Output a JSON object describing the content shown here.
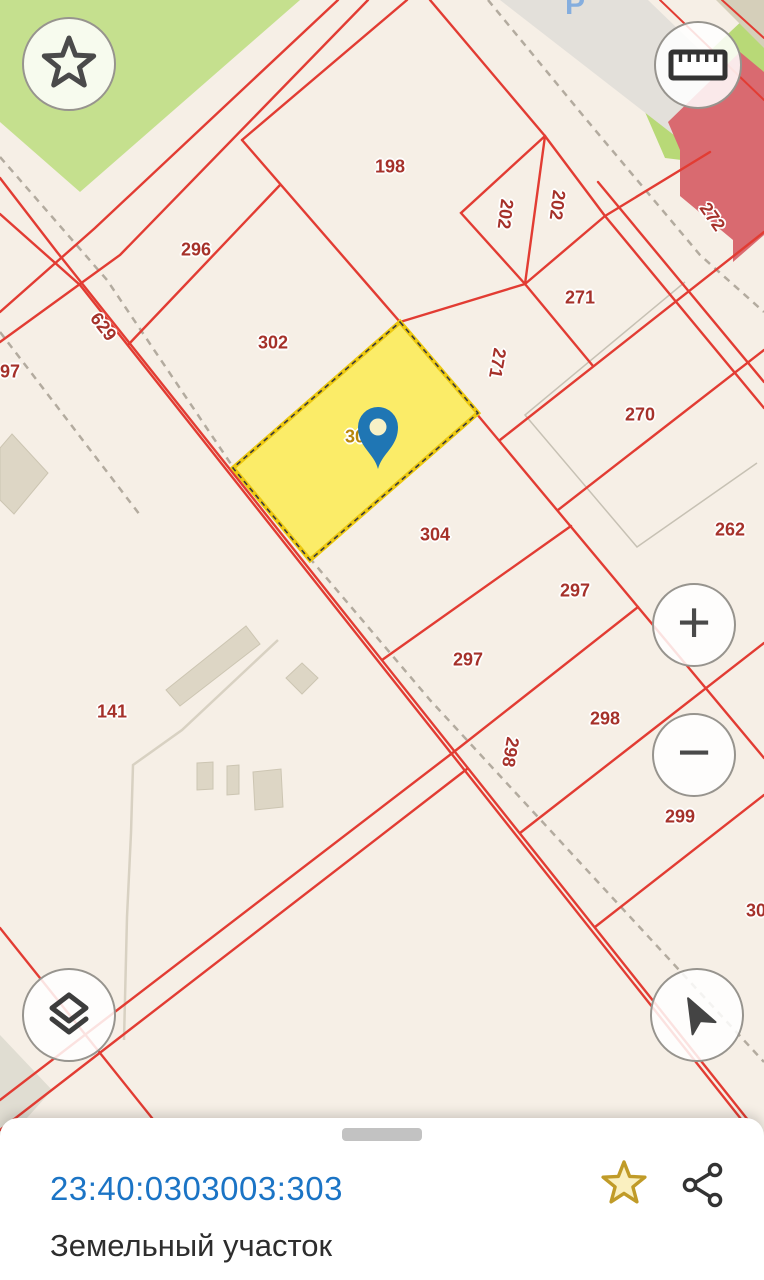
{
  "map": {
    "labels": [
      {
        "text": "198",
        "x": 390,
        "y": 167,
        "rot": 0,
        "cls": ""
      },
      {
        "text": "202",
        "x": 505,
        "y": 214,
        "rot": 97,
        "cls": ""
      },
      {
        "text": "202",
        "x": 557,
        "y": 205,
        "rot": 97,
        "cls": ""
      },
      {
        "text": "296",
        "x": 196,
        "y": 250,
        "rot": 0,
        "cls": ""
      },
      {
        "text": "271",
        "x": 580,
        "y": 298,
        "rot": 0,
        "cls": ""
      },
      {
        "text": "302",
        "x": 273,
        "y": 343,
        "rot": 0,
        "cls": ""
      },
      {
        "text": "271",
        "x": 497,
        "y": 363,
        "rot": 100,
        "cls": ""
      },
      {
        "text": "270",
        "x": 640,
        "y": 415,
        "rot": 0,
        "cls": ""
      },
      {
        "text": "297",
        "x": 5,
        "y": 372,
        "rot": 0,
        "cls": ""
      },
      {
        "text": "629",
        "x": 103,
        "y": 327,
        "rot": 52,
        "cls": ""
      },
      {
        "text": "303",
        "x": 360,
        "y": 437,
        "rot": 0,
        "cls": "selected"
      },
      {
        "text": "262",
        "x": 730,
        "y": 530,
        "rot": 0,
        "cls": ""
      },
      {
        "text": "304",
        "x": 435,
        "y": 535,
        "rot": 0,
        "cls": ""
      },
      {
        "text": "297",
        "x": 575,
        "y": 591,
        "rot": 0,
        "cls": ""
      },
      {
        "text": "297",
        "x": 468,
        "y": 660,
        "rot": 0,
        "cls": ""
      },
      {
        "text": "298",
        "x": 605,
        "y": 719,
        "rot": 0,
        "cls": ""
      },
      {
        "text": "298",
        "x": 510,
        "y": 752,
        "rot": 100,
        "cls": ""
      },
      {
        "text": "299",
        "x": 680,
        "y": 817,
        "rot": 0,
        "cls": ""
      },
      {
        "text": "141",
        "x": 112,
        "y": 712,
        "rot": 0,
        "cls": ""
      },
      {
        "text": "272",
        "x": 712,
        "y": 217,
        "rot": 55,
        "cls": ""
      },
      {
        "text": "30",
        "x": 756,
        "y": 911,
        "rot": 0,
        "cls": ""
      },
      {
        "text": "P",
        "x": 575,
        "y": 5,
        "rot": 0,
        "cls": "parking"
      }
    ],
    "selected_parcel_number": "303"
  },
  "controls": {
    "favorites_icon": "star-outline",
    "measure_icon": "ruler",
    "zoom_in_label": "+",
    "zoom_out_label": "−",
    "layers_icon": "layers",
    "compass_icon": "navigation-arrow"
  },
  "bottom_sheet": {
    "cadastral_number": "23:40:0303003:303",
    "subtitle": "Земельный участок",
    "favorite_icon": "star-filled",
    "share_icon": "share"
  },
  "colors": {
    "parcel_line_red": "#e23c33",
    "parcel_label_red": "#a5312a",
    "selected_parcel_fill": "#fbec68",
    "selected_label_gold": "#b8860b",
    "pin_blue": "#1f76b4",
    "link_blue": "#1b74c5",
    "greenery": "#c5e08e",
    "building_rose": "#d96a70",
    "map_background": "#f6efe6",
    "favorite_star_gold": "#c09b28"
  }
}
